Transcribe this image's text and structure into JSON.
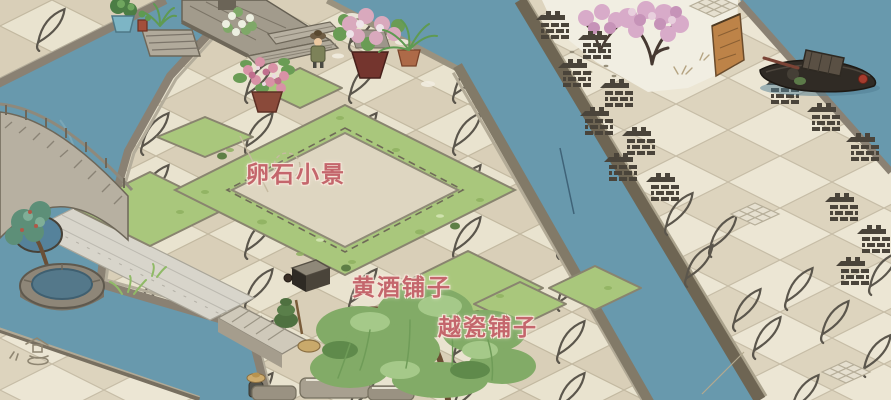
{
  "labels": {
    "pebble_scene": "卵石小景",
    "yellow_wine_shop": "黄酒铺子",
    "yue_porcelain_shop": "越瓷铺子"
  },
  "palette": {
    "water": "#6899ad",
    "tile_light": "#e9e3cf",
    "tile_dark": "#d9cfb8",
    "grass": "#a9c77c",
    "snow": "#f1eee2",
    "blossom": "#d8abc9",
    "stone": "#8a8173",
    "cliff": "#bd8348",
    "boat_wood": "#302b25",
    "label_text": "#c4666c"
  },
  "icons": {
    "tile_motif": "leaf-icon",
    "walkway_motif": "brick-wall-icon",
    "bank_sketch": "stone-lantern-icon",
    "path_motif": "grid-tile-icon"
  }
}
